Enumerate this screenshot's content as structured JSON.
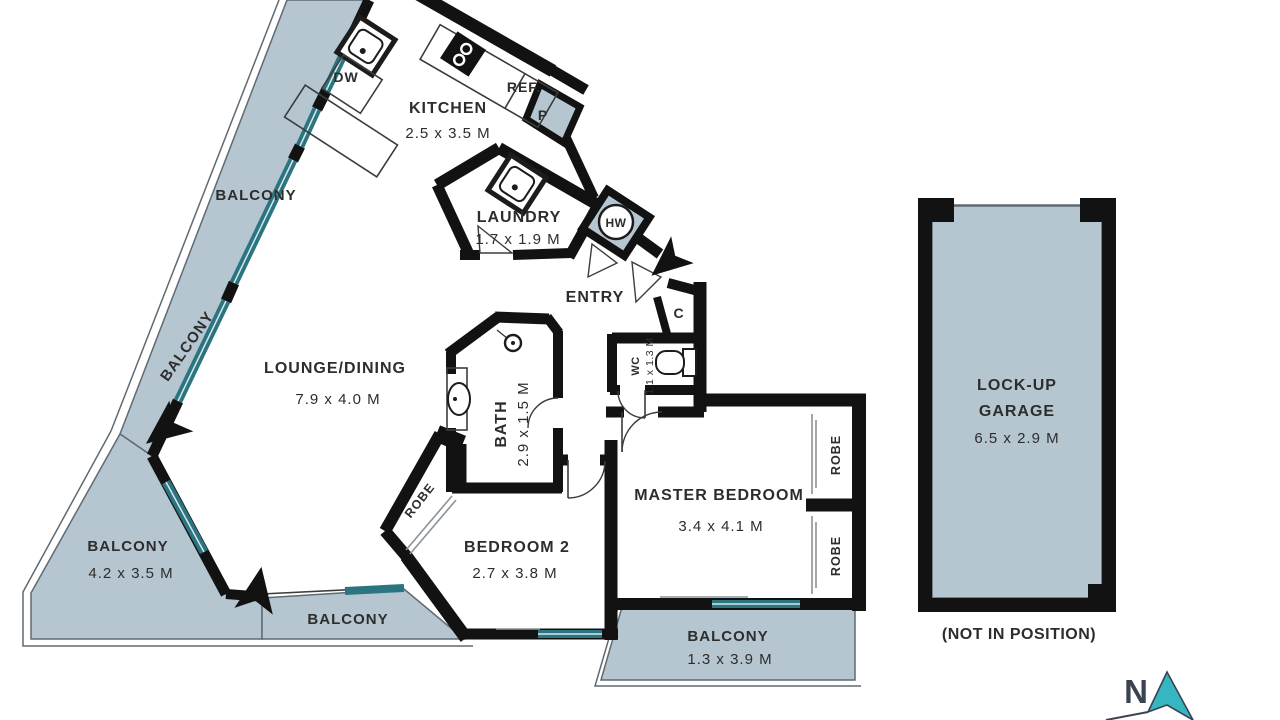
{
  "colors": {
    "balcony_fill": "#b5c6d1",
    "wall": "#121212",
    "window_teal": "#2a7580",
    "rail_line": "#5f6a72",
    "text_color": "#2d2d2d",
    "compass_teal": "#35b6c1",
    "north_letter": "#3b4350"
  },
  "labels": {
    "kitchen": "KITCHEN",
    "kitchen_dims": "2.5 x 3.5 M",
    "laundry": "LAUNDRY",
    "laundry_dims": "1.7 x 1.9 M",
    "entry": "ENTRY",
    "lounge": "LOUNGE/DINING",
    "lounge_dims": "7.9 x 4.0 M",
    "bath": "BATH",
    "bath_dims": "2.9 x 1.5 M",
    "wc": "WC",
    "wc_dims": "1.1 x 1.3 M",
    "master": "MASTER BEDROOM",
    "master_dims": "3.4 x 4.1 M",
    "bedroom2": "BEDROOM 2",
    "bedroom2_dims": "2.7 x 3.8 M",
    "balcony": "BALCONY",
    "balcony_sw_dims": "4.2 x 3.5 M",
    "balcony_se_dims": "1.3 x 3.9 M",
    "garage_line1": "LOCK-UP",
    "garage_line2": "GARAGE",
    "garage_dims": "6.5 x 2.9 M",
    "garage_note": "(NOT IN POSITION)",
    "dw": "DW",
    "ref": "REF.",
    "pantry": "P",
    "hw": "HW",
    "cupboard": "C",
    "robe": "ROBE",
    "north": "N"
  }
}
